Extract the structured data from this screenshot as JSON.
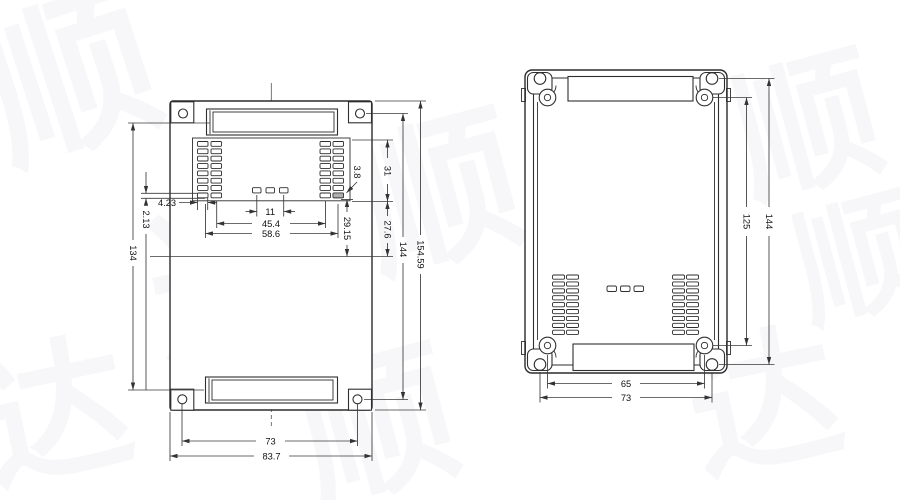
{
  "watermark": {
    "char_a": "顺",
    "char_b": "达"
  },
  "left_view": {
    "description": "pcb-base-plan-view",
    "dims": {
      "slot_row_height": "2.13",
      "column_offset": "4.23",
      "mid_slot_pitch": "11",
      "array_inner_span": "45.4",
      "array_outer_span": "58.6",
      "slot_center_distance": "134",
      "slot_to_mid_line": "29.15",
      "slot_width": "3.8",
      "vent_top_span": "31",
      "vent_bottom_span": "27.6",
      "hole_pitch_vertical": "144",
      "body_height": "154.59",
      "hole_pitch_horizontal": "73",
      "body_width": "83.7"
    }
  },
  "right_view": {
    "description": "enclosure-inside-view",
    "dims": {
      "boss_pitch_vertical": "125",
      "hole_pitch_vertical": "144",
      "boss_pitch_horizontal": "65",
      "hole_pitch_horizontal": "73"
    }
  }
}
